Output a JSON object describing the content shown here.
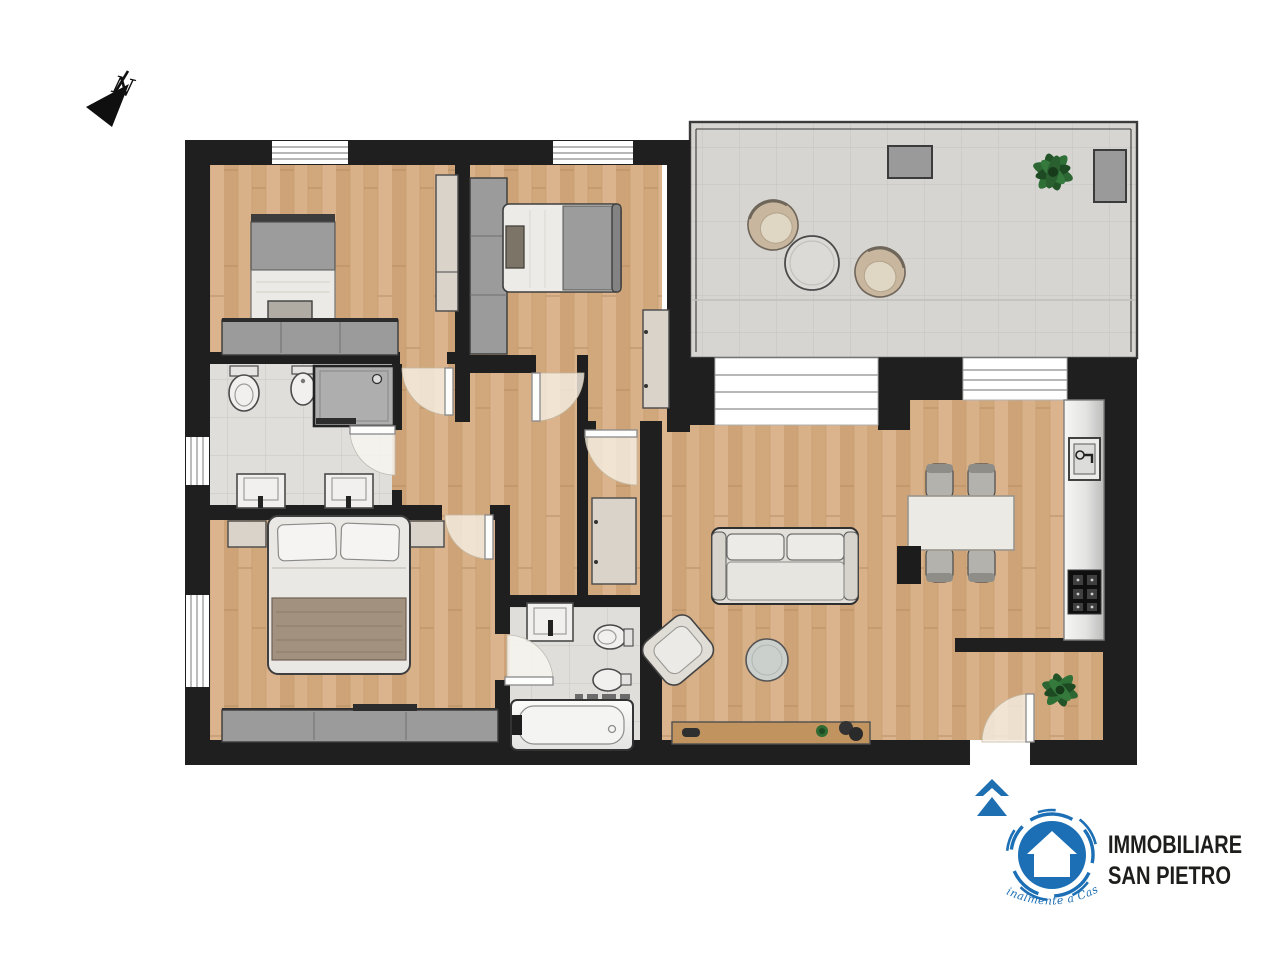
{
  "page": {
    "background_color": "#ffffff"
  },
  "compass": {
    "north_label": "N"
  },
  "entrance": {
    "arrow_color": "#1e6fb2"
  },
  "palette": {
    "wall": "#1f1f1f",
    "wood_floor": "#d3aa7e",
    "bathroom_tile": "#dfdedb",
    "terrace_tile": "#d6d5d1",
    "furniture_gray": "#9b9b9b",
    "linen_white": "#eceae6",
    "blanket_brown": "#a3917f",
    "plant_green": "#2c6632",
    "brand_blue": "#1c6fb4",
    "brand_text_color": "#1d1d1b"
  },
  "logo": {
    "name_line1": "IMMOBILIARE",
    "name_line2": "SAN PIETRO",
    "tagline": "Finalmente a Casa"
  }
}
